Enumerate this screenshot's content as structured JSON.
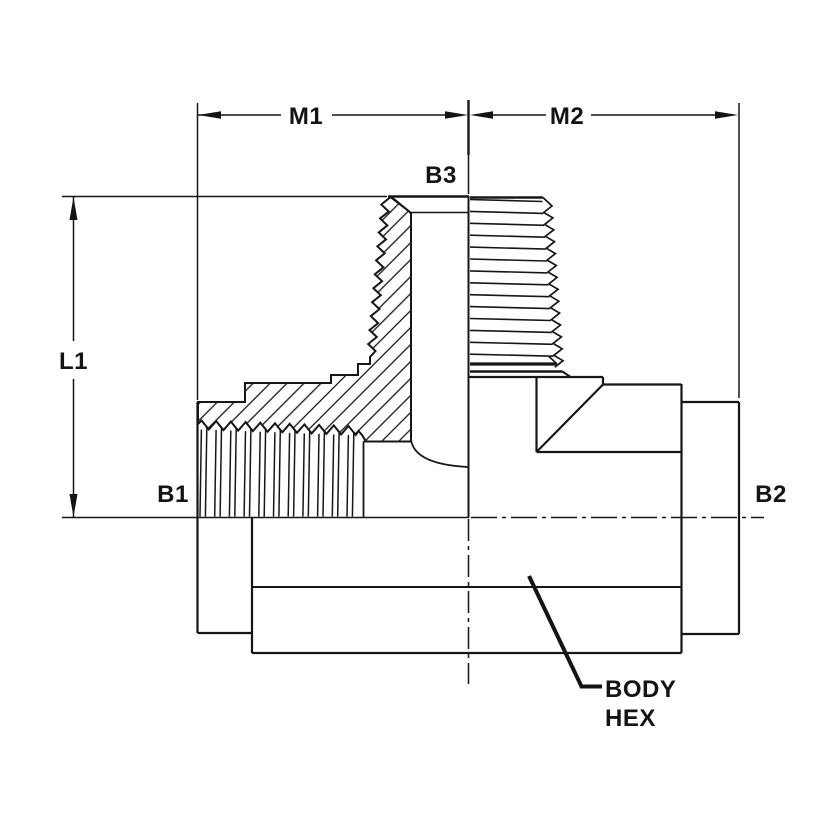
{
  "drawing": {
    "type": "engineering-section-drawing",
    "line_color": "#161616",
    "background": "#ffffff",
    "dimension_labels": {
      "m1": "M1",
      "m2": "M2",
      "l1": "L1"
    },
    "port_labels": {
      "b1": "B1",
      "b2": "B2",
      "b3": "B3"
    },
    "callout": {
      "line1": "BODY",
      "line2": "HEX"
    }
  }
}
